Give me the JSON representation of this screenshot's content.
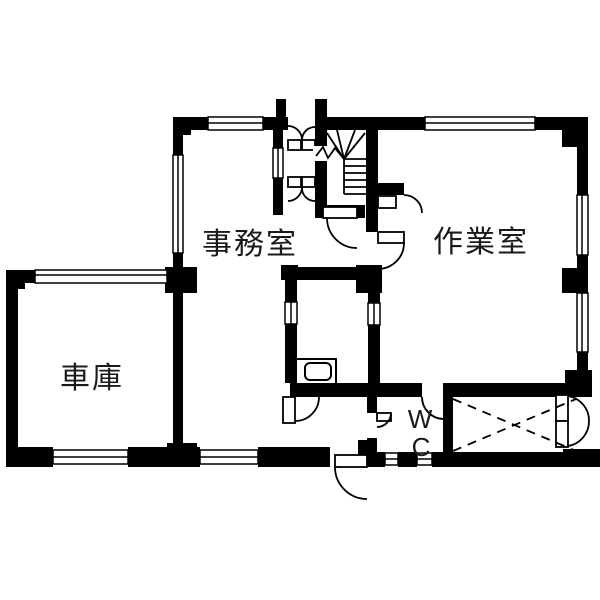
{
  "floorplan": {
    "type": "japanese-floor-plan",
    "rooms": {
      "office": {
        "label": "事務室"
      },
      "workshop": {
        "label": "作業室"
      },
      "garage": {
        "label": "車庫"
      },
      "wc": {
        "label": "WC",
        "line1": "W",
        "line2": "C"
      }
    },
    "colors": {
      "wall": "#000000",
      "background": "#ffffff",
      "text": "#1a1a1a"
    }
  }
}
